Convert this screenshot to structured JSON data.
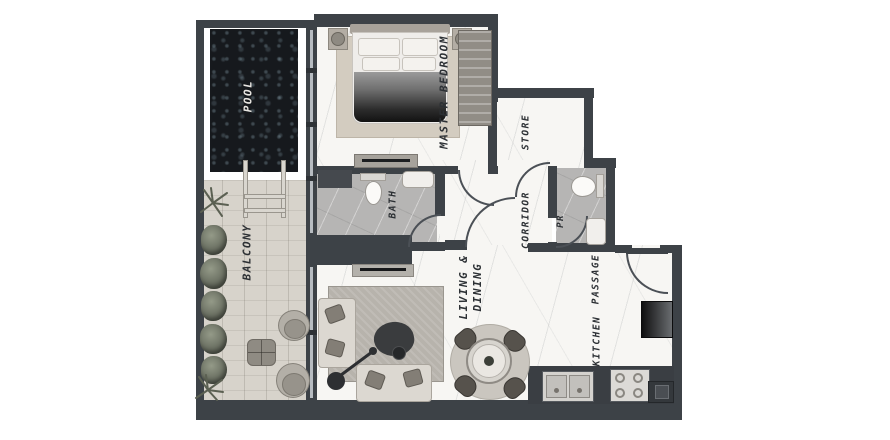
{
  "rooms": {
    "pool": "POOL",
    "balcony": "BALCONY",
    "master_bedroom": "MASTER BEDROOM",
    "bath": "BATH",
    "store": "STORE",
    "corridor": "CORRIDOR",
    "pr": "PR",
    "living1": "LIVING &",
    "living2": "DINING",
    "passage": "PASSAGE",
    "kitchen": "KITCHEN"
  },
  "colors": {
    "wall": "#3d4247",
    "pool_water": "#16191d",
    "balcony_wood": "#d7d3cb",
    "marble": "#f7f6f3",
    "tile": "#b6b5b4",
    "label_text": "#2c3034",
    "pool_label_text": "#e9e7e3"
  }
}
